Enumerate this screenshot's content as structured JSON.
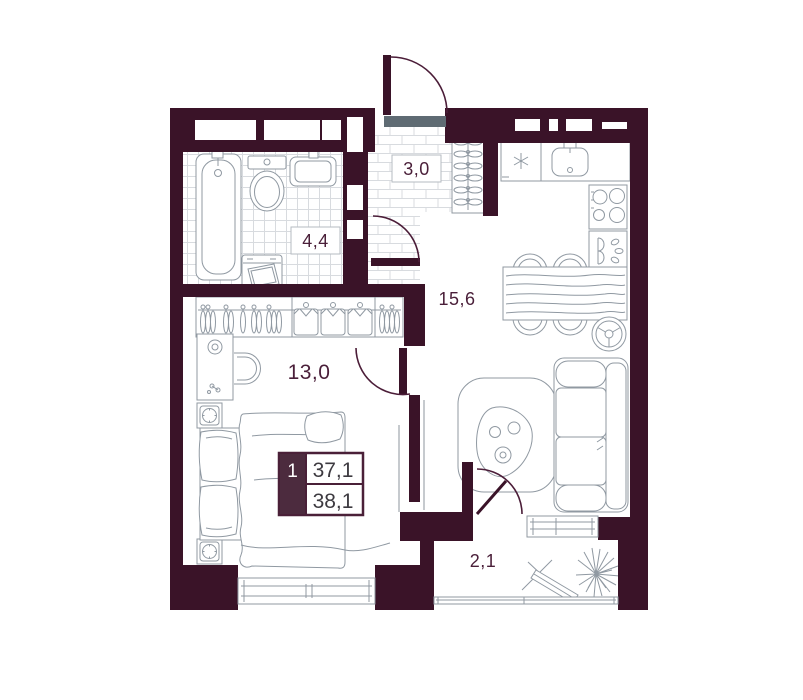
{
  "plan": {
    "title": "one-room apartment floor plan",
    "rooms": [
      {
        "name": "hallway",
        "area_label": "3,0"
      },
      {
        "name": "bathroom",
        "area_label": "4,4"
      },
      {
        "name": "kitchen-living-room",
        "area_label": "15,6"
      },
      {
        "name": "bedroom",
        "area_label": "13,0"
      },
      {
        "name": "balcony",
        "area_label": "2,1"
      }
    ],
    "legend": {
      "unit_number": "1",
      "living_area": "37,1",
      "total_area": "38,1"
    },
    "colors": {
      "wall": "#3A1328",
      "door_swing": "#4B1D38",
      "room_label_text": "#4A1F39",
      "legend_number_bg": "#4C2B3E",
      "legend_value_text": "#3D3A40",
      "entrance_threshold": "#5F6B73",
      "furniture_line": "#9099A2",
      "floor_grid_line": "#D8DBDF"
    }
  }
}
